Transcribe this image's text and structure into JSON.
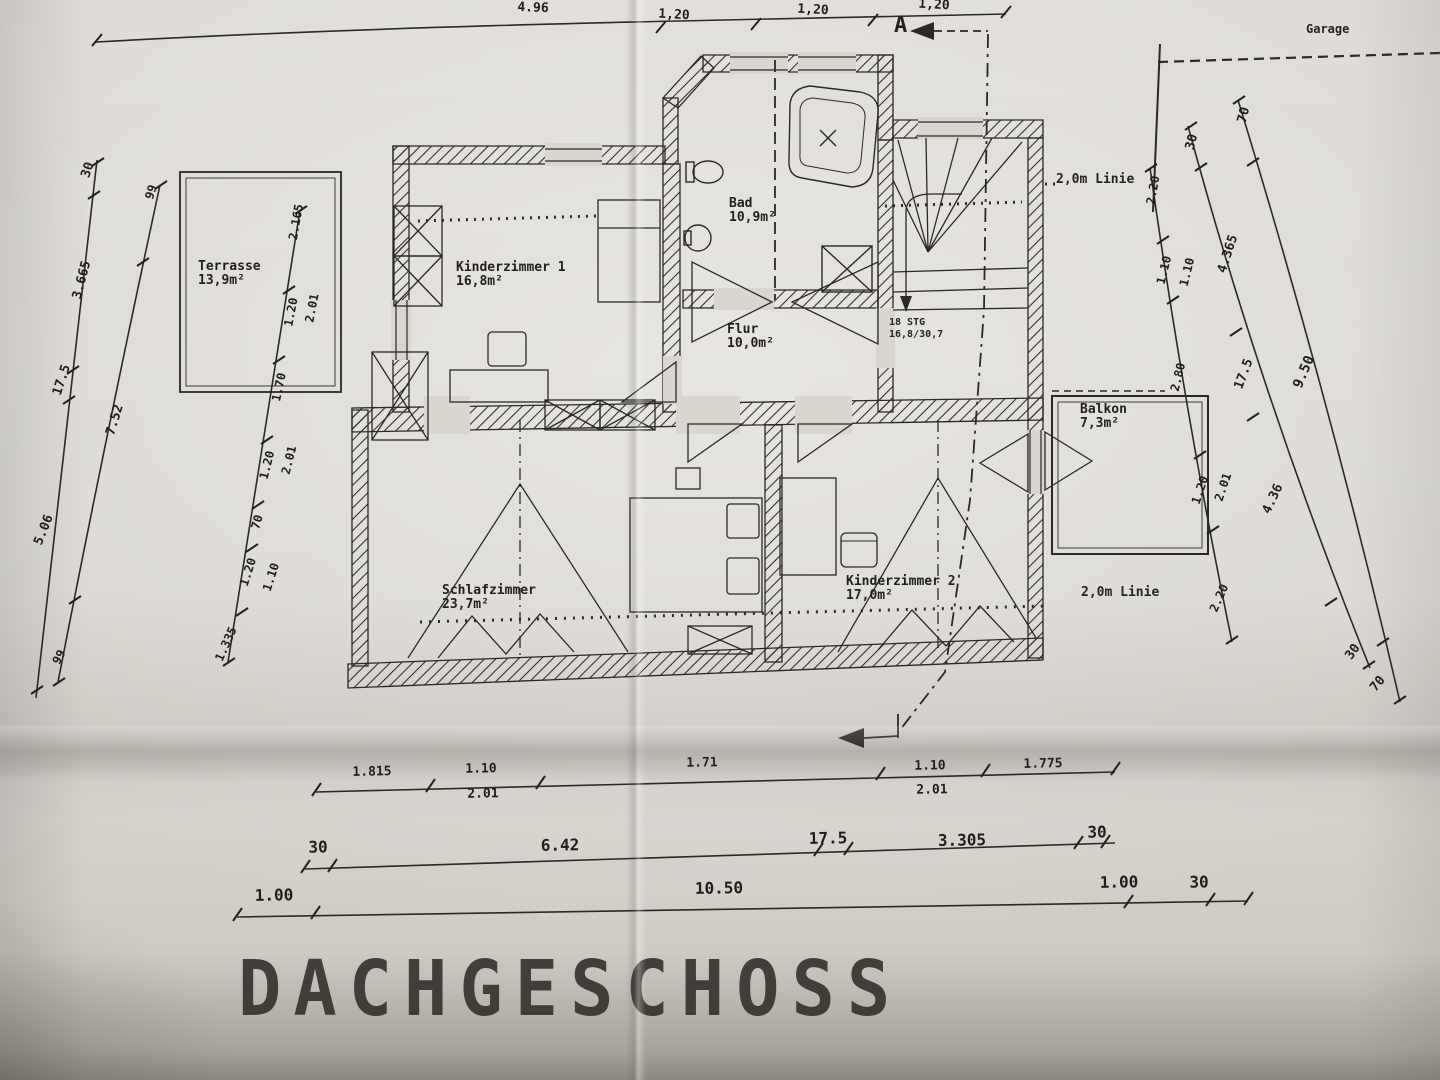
{
  "title": "DACHGESCHOSS",
  "texts": {
    "garage": "Garage",
    "line2m_top": "2,0m Linie",
    "line2m_bottom": "2,0m Linie",
    "stairs_line1": "18 STG",
    "stairs_line2": "16,8/30,7",
    "section_marker": "A"
  },
  "rooms": [
    {
      "name": "Terrasse",
      "area": "13,9m²",
      "x": 198,
      "y": 260
    },
    {
      "name": "Kinderzimmer 1",
      "area": "16,8m²",
      "x": 456,
      "y": 261
    },
    {
      "name": "Bad",
      "area": "10,9m²",
      "x": 729,
      "y": 197
    },
    {
      "name": "Flur",
      "area": "10,0m²",
      "x": 727,
      "y": 323
    },
    {
      "name": "Schlafzimmer",
      "area": "23,7m²",
      "x": 442,
      "y": 584
    },
    {
      "name": "Kinderzimmer 2",
      "area": "17,0m²",
      "x": 846,
      "y": 575
    },
    {
      "name": "Balkon",
      "area": "7,3m²",
      "x": 1080,
      "y": 403
    }
  ],
  "dims": [
    {
      "t": "4.96",
      "x": 533,
      "y": 8,
      "r": 2,
      "s": 13
    },
    {
      "t": "1,20",
      "x": 674,
      "y": 15,
      "r": 3,
      "s": 13
    },
    {
      "t": "1,20",
      "x": 813,
      "y": 10,
      "r": 3,
      "s": 13
    },
    {
      "t": "1,20",
      "x": 934,
      "y": 5,
      "r": 3,
      "s": 13
    },
    {
      "t": "30",
      "x": 88,
      "y": 170,
      "r": -72,
      "s": 13
    },
    {
      "t": "99",
      "x": 151,
      "y": 192,
      "r": -72,
      "s": 12
    },
    {
      "t": "3.665",
      "x": 82,
      "y": 280,
      "r": -75,
      "s": 13
    },
    {
      "t": "17.5",
      "x": 62,
      "y": 380,
      "r": -72,
      "s": 13
    },
    {
      "t": "7.52",
      "x": 115,
      "y": 420,
      "r": -73,
      "s": 13
    },
    {
      "t": "5.06",
      "x": 44,
      "y": 530,
      "r": -68,
      "s": 13
    },
    {
      "t": "99",
      "x": 59,
      "y": 657,
      "r": -62,
      "s": 12
    },
    {
      "t": "2.165",
      "x": 296,
      "y": 222,
      "r": -80,
      "s": 12
    },
    {
      "t": "1.20",
      "x": 291,
      "y": 312,
      "r": -79,
      "s": 12
    },
    {
      "t": "2.01",
      "x": 312,
      "y": 308,
      "r": -79,
      "s": 12
    },
    {
      "t": "1.70",
      "x": 279,
      "y": 387,
      "r": -78,
      "s": 12
    },
    {
      "t": "1.20",
      "x": 267,
      "y": 465,
      "r": -76,
      "s": 12
    },
    {
      "t": "2.01",
      "x": 289,
      "y": 460,
      "r": -76,
      "s": 12
    },
    {
      "t": "70",
      "x": 257,
      "y": 522,
      "r": -74,
      "s": 12
    },
    {
      "t": "1.20",
      "x": 248,
      "y": 572,
      "r": -72,
      "s": 12
    },
    {
      "t": "1.10",
      "x": 271,
      "y": 577,
      "r": -72,
      "s": 12
    },
    {
      "t": "1.335",
      "x": 226,
      "y": 644,
      "r": -66,
      "s": 12
    },
    {
      "t": "70",
      "x": 1244,
      "y": 115,
      "r": -75,
      "s": 13
    },
    {
      "t": "30",
      "x": 1192,
      "y": 142,
      "r": -75,
      "s": 13
    },
    {
      "t": "2.20",
      "x": 1153,
      "y": 190,
      "r": -80,
      "s": 12
    },
    {
      "t": "1.10",
      "x": 1164,
      "y": 270,
      "r": -76,
      "s": 12
    },
    {
      "t": "1.10",
      "x": 1187,
      "y": 272,
      "r": -76,
      "s": 12
    },
    {
      "t": "4.365",
      "x": 1228,
      "y": 254,
      "r": -72,
      "s": 13
    },
    {
      "t": "2.80",
      "x": 1178,
      "y": 377,
      "r": -76,
      "s": 12
    },
    {
      "t": "17.5",
      "x": 1244,
      "y": 374,
      "r": -70,
      "s": 13
    },
    {
      "t": "9.50",
      "x": 1304,
      "y": 372,
      "r": -67,
      "s": 14
    },
    {
      "t": "1.20",
      "x": 1200,
      "y": 490,
      "r": -71,
      "s": 12
    },
    {
      "t": "2.01",
      "x": 1223,
      "y": 487,
      "r": -71,
      "s": 12
    },
    {
      "t": "4.36",
      "x": 1273,
      "y": 499,
      "r": -65,
      "s": 13
    },
    {
      "t": "2.20",
      "x": 1219,
      "y": 598,
      "r": -66,
      "s": 12
    },
    {
      "t": "30",
      "x": 1353,
      "y": 652,
      "r": -55,
      "s": 13
    },
    {
      "t": "70",
      "x": 1378,
      "y": 684,
      "r": -50,
      "s": 13
    },
    {
      "t": "1.815",
      "x": 372,
      "y": 772,
      "r": -1,
      "s": 13
    },
    {
      "t": "1.10",
      "x": 481,
      "y": 769,
      "r": -1,
      "s": 13
    },
    {
      "t": "2.01",
      "x": 483,
      "y": 794,
      "r": -1,
      "s": 13
    },
    {
      "t": "1.71",
      "x": 702,
      "y": 763,
      "r": -1,
      "s": 13
    },
    {
      "t": "1.10",
      "x": 930,
      "y": 766,
      "r": -1,
      "s": 13
    },
    {
      "t": "2.01",
      "x": 932,
      "y": 790,
      "r": -1,
      "s": 13
    },
    {
      "t": "1.775",
      "x": 1043,
      "y": 764,
      "r": -1,
      "s": 13
    },
    {
      "t": "30",
      "x": 318,
      "y": 847,
      "r": -1,
      "s": 16
    },
    {
      "t": "6.42",
      "x": 560,
      "y": 845,
      "r": -1,
      "s": 16
    },
    {
      "t": "17.5",
      "x": 828,
      "y": 838,
      "r": -1,
      "s": 16
    },
    {
      "t": "3.305",
      "x": 962,
      "y": 840,
      "r": -1,
      "s": 16
    },
    {
      "t": "30",
      "x": 1097,
      "y": 832,
      "r": -1,
      "s": 16
    },
    {
      "t": "1.00",
      "x": 274,
      "y": 895,
      "r": -1,
      "s": 16
    },
    {
      "t": "10.50",
      "x": 719,
      "y": 888,
      "r": -1,
      "s": 16
    },
    {
      "t": "1.00",
      "x": 1119,
      "y": 882,
      "r": -1,
      "s": 16
    },
    {
      "t": "30",
      "x": 1199,
      "y": 882,
      "r": -1,
      "s": 16
    }
  ]
}
